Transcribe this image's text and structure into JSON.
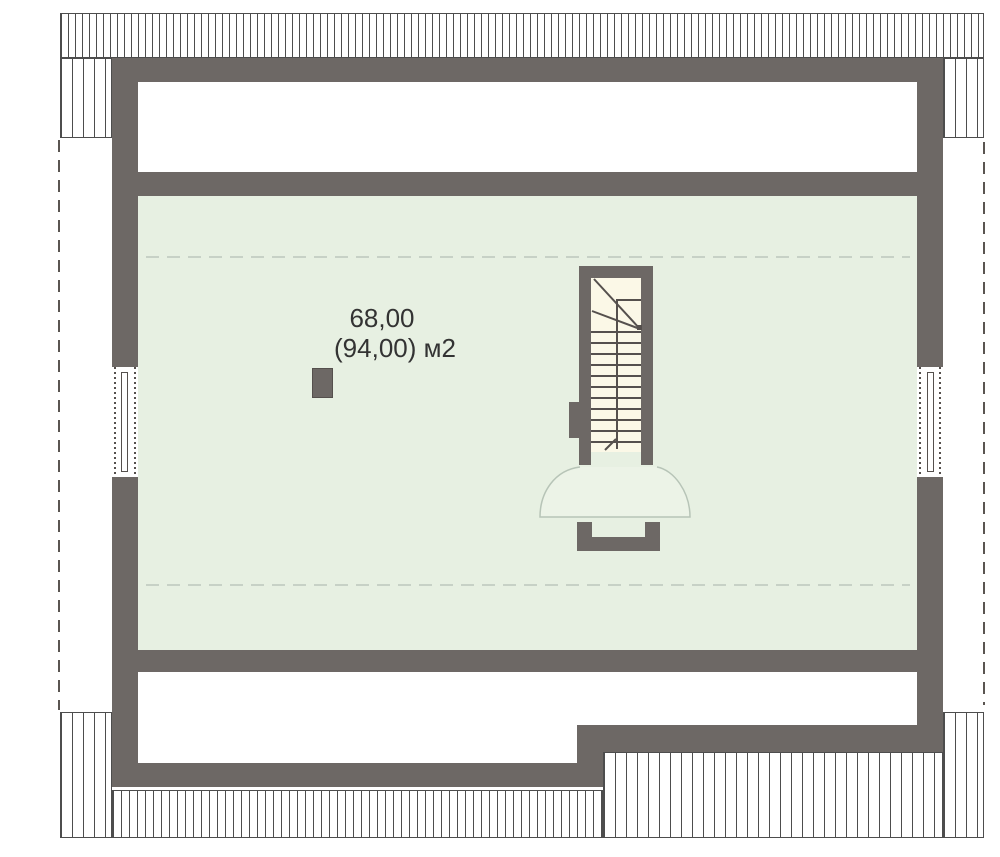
{
  "plan": {
    "room": {
      "area_label": {
        "line1": "68,00",
        "line2": "(94,00) м2"
      }
    }
  },
  "colors": {
    "wall": "#6d6865",
    "floor": "#e7f0e2",
    "stairwell": "#fbf8e7",
    "fan_fill": "#ecf3e7",
    "fan_stroke": "#b7c4b7",
    "hatch_line": "#4d4d4d",
    "stair_line": "#55504d",
    "ceiling_dash": "#c7d1c6",
    "roof_dash": "#5a5551",
    "text": "#333333",
    "background": "#ffffff"
  }
}
